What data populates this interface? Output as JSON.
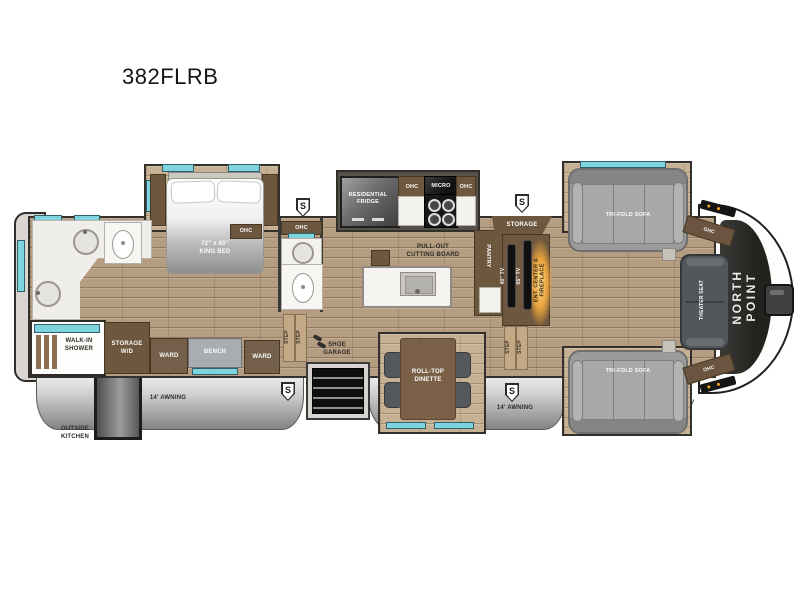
{
  "title": "382FLRB",
  "colors": {
    "wood": "#b59d82",
    "slide_wood": "#c6b195",
    "window_glass": "#7ed4de",
    "cabinet_brown": "#6d573f",
    "fireplace_glow": "#e8a33d",
    "front_cap": "#2b2a28",
    "awning_silver": "#bfbfbf",
    "sofa_gray": "#9b9b9b"
  },
  "labels": {
    "speaker": "S",
    "step": "STEP",
    "ohc": "OHC",
    "ward": "WARD",
    "awning": "14' AWNING",
    "tri_fold_sofa": "TRI-FOLD SOFA",
    "king_bed": "72\" x 80\"\nKING BED",
    "walk_in_shower": "WALK-IN\nSHOWER",
    "storage_wd": "STORAGE\nW/D",
    "bench": "BENCH",
    "outside_kitchen": "OUTSIDE\nKITCHEN",
    "residential_fridge": "RESIDENTIAL\nFRIDGE",
    "micro": "MICRO",
    "pull_out_cutting_board": "PULL-OUT\nCUTTING BOARD",
    "pantry": "PANTRY",
    "shoe_garage": "SHOE\nGARAGE",
    "roll_top_dinette": "ROLL-TOP\nDINETTE",
    "storage": "STORAGE",
    "tv_40": "40\" TV",
    "tv_65": "65\" TV",
    "ent_center_fireplace": "ENT. CENTER &\nFIREPLACE",
    "theater_seat": "THEATER SEAT",
    "brand": "NORTH POINT",
    "tailgate_tv": "TAILGATE TV\n(OPTION)"
  }
}
